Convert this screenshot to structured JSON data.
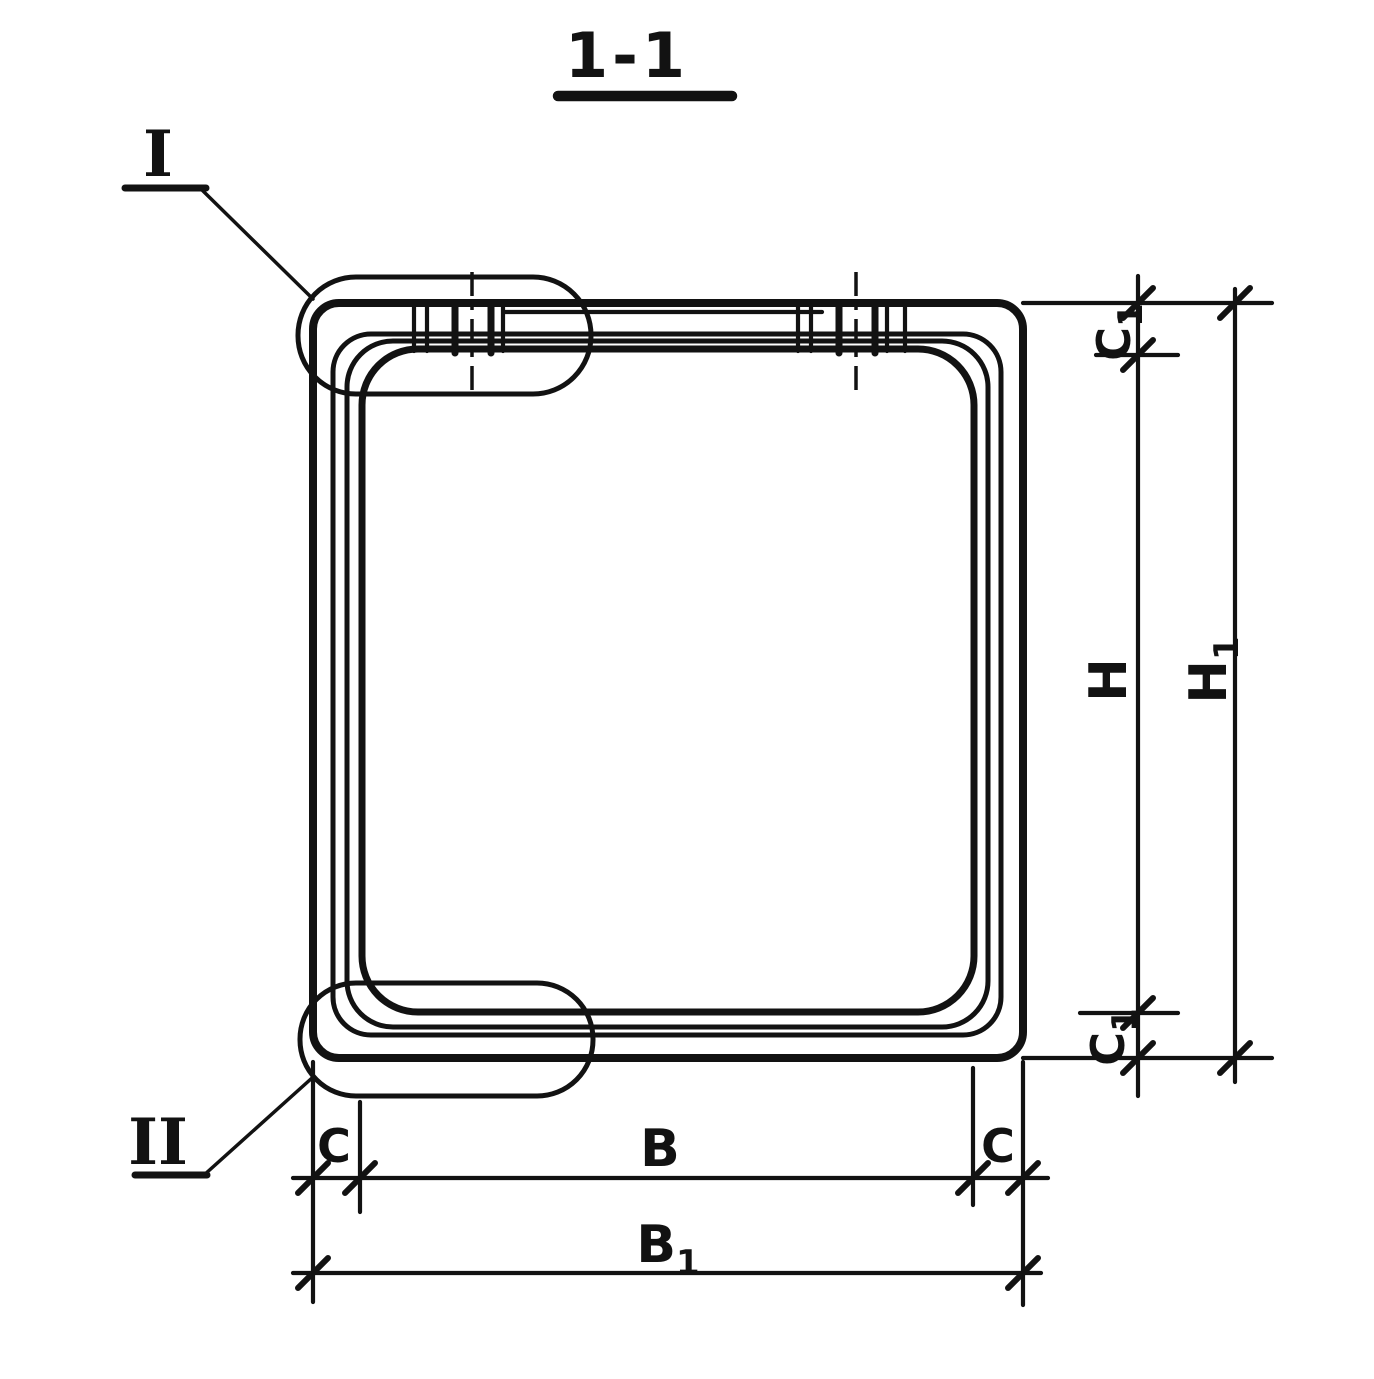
{
  "title": {
    "text": "1-1"
  },
  "callouts": {
    "detail_top": {
      "label": "I"
    },
    "detail_bottom": {
      "label": "II"
    }
  },
  "dimensions": {
    "c1_top": {
      "base": "C",
      "sub": "1"
    },
    "h": {
      "base": "H",
      "sub": ""
    },
    "h1": {
      "base": "H",
      "sub": "1"
    },
    "c1_bottom": {
      "base": "C",
      "sub": "1"
    },
    "c_left": {
      "base": "C",
      "sub": ""
    },
    "b": {
      "base": "B",
      "sub": ""
    },
    "c_right": {
      "base": "C",
      "sub": ""
    },
    "b1": {
      "base": "B",
      "sub": "1"
    }
  },
  "colors": {
    "ink": "#121212",
    "paper": "#ffffff"
  }
}
